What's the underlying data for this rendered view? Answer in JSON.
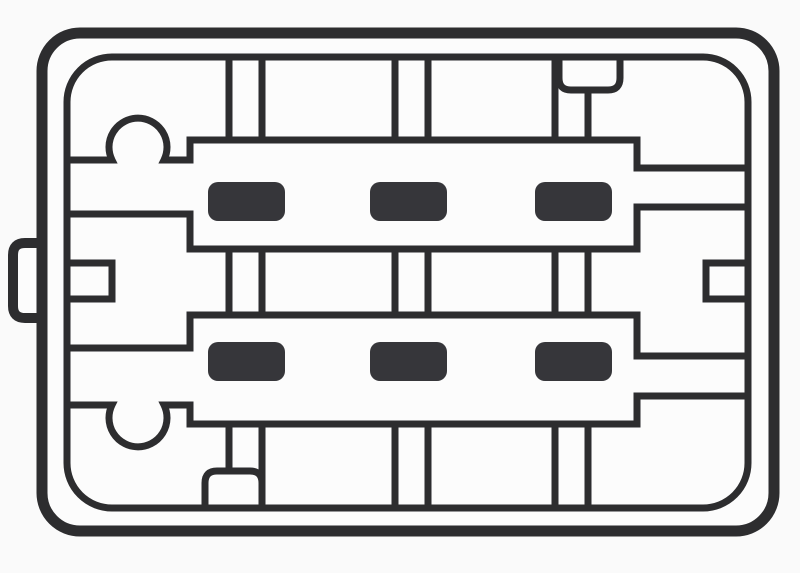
{
  "page": {
    "background": "#fafafa"
  },
  "diagram": {
    "title": "Electrical connector housing, front face view",
    "style": "black-and-white technical line art",
    "pin_count": 6,
    "pin_rows": 2,
    "pin_columns": 3,
    "features": [
      "outer-housing-outline",
      "inner-housing-wall",
      "side-latch-tab",
      "upper-terminal-rail",
      "lower-terminal-rail",
      "terminal-pins",
      "guide-ribs",
      "keying-bump-top",
      "keying-bump-bottom",
      "index-notch-top",
      "index-notch-bottom",
      "keying-slot-left",
      "keying-slot-right"
    ]
  },
  "colors": {
    "ink": "#2d2d2f",
    "surface": "#fcfcfc",
    "pin_fill": "#36363a",
    "background": "#fafafa"
  },
  "pins": {
    "column_x": [
      208,
      370,
      535
    ],
    "row_y": [
      182,
      342
    ],
    "width": 77,
    "height": 39,
    "corner_radius": 10
  }
}
